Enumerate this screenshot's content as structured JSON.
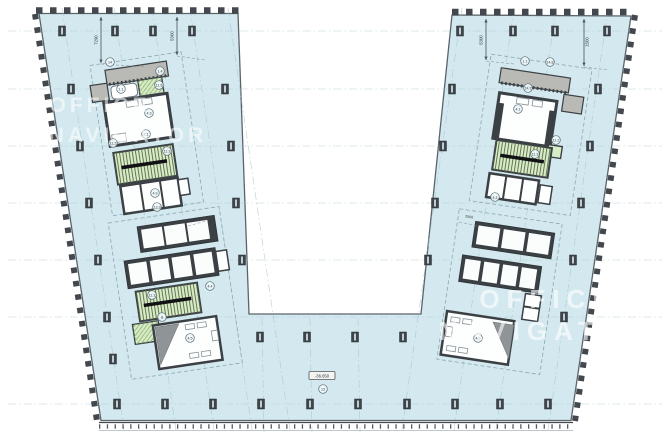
{
  "colors": {
    "floor": "#d3e9ef",
    "stair": "#d8edc5",
    "slab": "#b9bab5",
    "wall": "#3b4045",
    "hatch": "#8fb37c",
    "grid": "#a6c3cc",
    "watermark": "#ffffff"
  },
  "watermark": {
    "line1": "OFFICE",
    "line2": "NAVIGATOR"
  },
  "dimensions": {
    "d1": "7290",
    "d2": "5300",
    "d3": "5300",
    "d4": "1500",
    "b": "600",
    "dd": "2500"
  },
  "elevation": "-36.650",
  "circle_labels": {
    "a1": "14",
    "a2": "1.4",
    "a3": "11.5",
    "a4": "1.1",
    "a5": "4.3",
    "a6": "2.1",
    "a7": "11.2",
    "a8": "11.3",
    "a9": "4.9",
    "a10": "13.3",
    "b1": "11.3",
    "b2": "4.4",
    "b3": "8",
    "b4": "4.5",
    "c1": "1.1",
    "c2": "14.8",
    "c3": "14.2",
    "c4": "4.1",
    "c5": "11.2",
    "c6": "11.3",
    "c7": "1.1",
    "d1": "4.6",
    "e1": "13"
  }
}
